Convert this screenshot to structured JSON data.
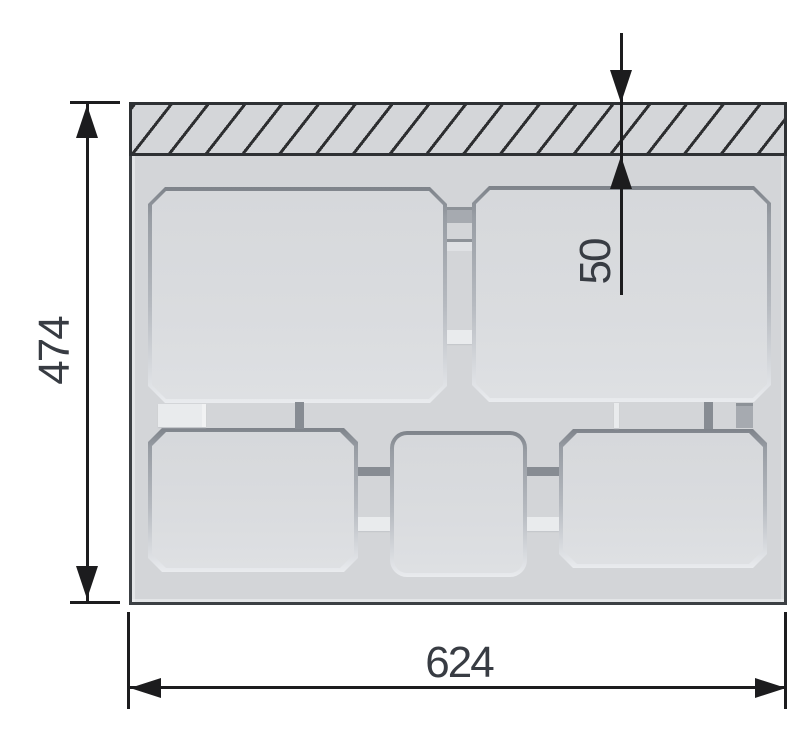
{
  "drawing": {
    "kind": "dimensioned technical drawing of a tray insert (top view) with hatched rail strip and five pockets",
    "dimensions": {
      "height": "474",
      "width": "624",
      "strip_depth": "50"
    },
    "palette": {
      "background": "#ffffff",
      "surface": "#d3d5d8",
      "pocket_fill": "#dadce0",
      "pocket_rim_dark": "#878c93",
      "hatch_line": "#2d2e30",
      "dimension_line": "#1c1c1e",
      "dimension_text": "#383c43"
    }
  }
}
